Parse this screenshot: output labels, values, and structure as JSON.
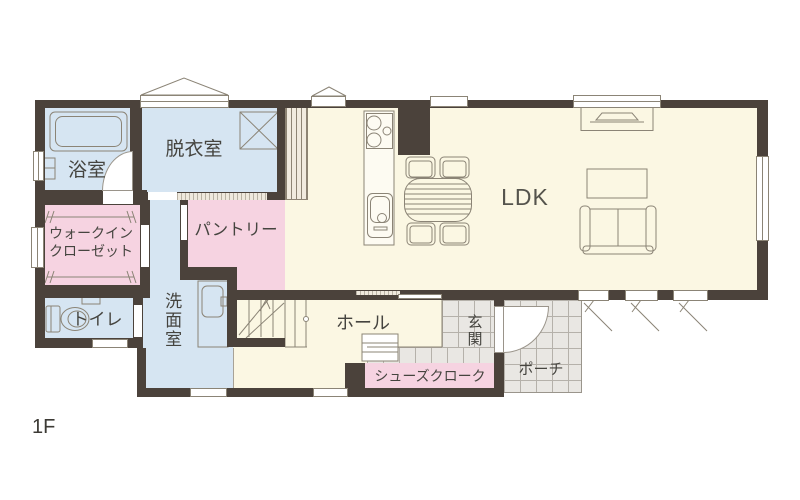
{
  "floor": {
    "label": "1F"
  },
  "rooms": {
    "bathroom": {
      "label": "浴室"
    },
    "dressing_room": {
      "label": "脱衣室"
    },
    "walk_in_closet": {
      "label_line1": "ウォークイン",
      "label_line2": "クローゼット"
    },
    "pantry": {
      "label": "パントリー"
    },
    "toilet": {
      "label": "トイレ"
    },
    "washroom": {
      "label": "洗面室"
    },
    "hall": {
      "label": "ホール"
    },
    "entrance": {
      "label": "玄関"
    },
    "shoe_cloak": {
      "label": "シューズクローク"
    },
    "porch": {
      "label": "ポーチ"
    },
    "ldk": {
      "label": "LDK"
    }
  },
  "colors": {
    "wall": "#4b423b",
    "room_blue": "#d6e5f2",
    "room_pink": "#f6d3e1",
    "floor_cream": "#fbf7e3",
    "tile_gray": "#e9e7e3",
    "tile_line": "#b5b1aa",
    "furniture_outline": "#8b8476",
    "text": "#45443f"
  }
}
